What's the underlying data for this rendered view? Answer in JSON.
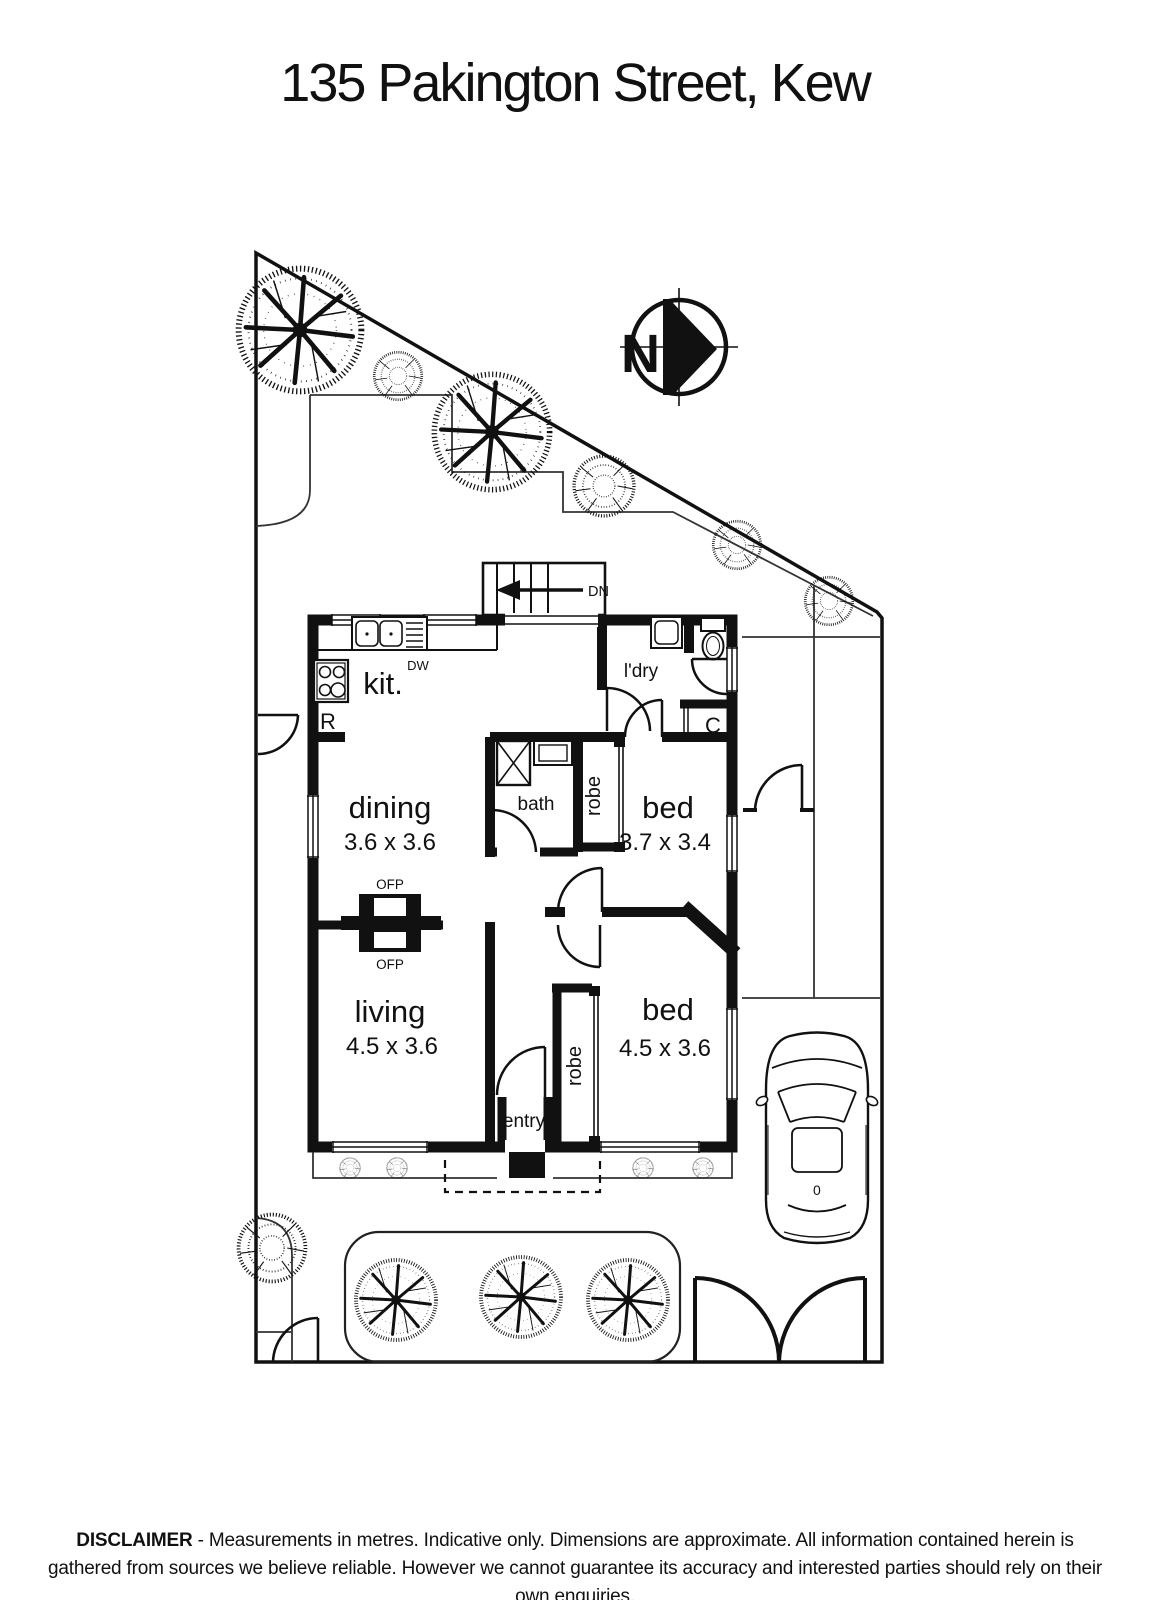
{
  "title": "135 Pakington Street, Kew",
  "compass": {
    "direction_label": "N"
  },
  "plan": {
    "stair_label": "DN",
    "annotations": {
      "dishwasher": "DW",
      "refrigerator": "R",
      "cupboard": "C",
      "fireplace_top": "OFP",
      "fireplace_bottom": "OFP",
      "car_marking": "0"
    },
    "rooms": {
      "kitchen": {
        "label": "kit."
      },
      "laundry": {
        "label": "l'dry"
      },
      "dining": {
        "label": "dining",
        "dimensions": "3.6 x 3.6"
      },
      "bath": {
        "label": "bath"
      },
      "robe_rear": {
        "label": "robe"
      },
      "bed_rear": {
        "label": "bed",
        "dimensions": "3.7 x 3.4"
      },
      "living": {
        "label": "living",
        "dimensions": "4.5 x 3.6"
      },
      "robe_front": {
        "label": "robe"
      },
      "bed_front": {
        "label": "bed",
        "dimensions": "4.5 x 3.6"
      },
      "entry": {
        "label": "entry"
      }
    }
  },
  "disclaimer": {
    "heading": "DISCLAIMER",
    "text": " - Measurements in metres. Indicative only. Dimensions are approximate. All information contained herein is gathered from sources we believe reliable. However we cannot guarantee its accuracy and interested parties should rely on their own enquiries."
  },
  "colors": {
    "ink": "#111111",
    "background": "#ffffff"
  }
}
